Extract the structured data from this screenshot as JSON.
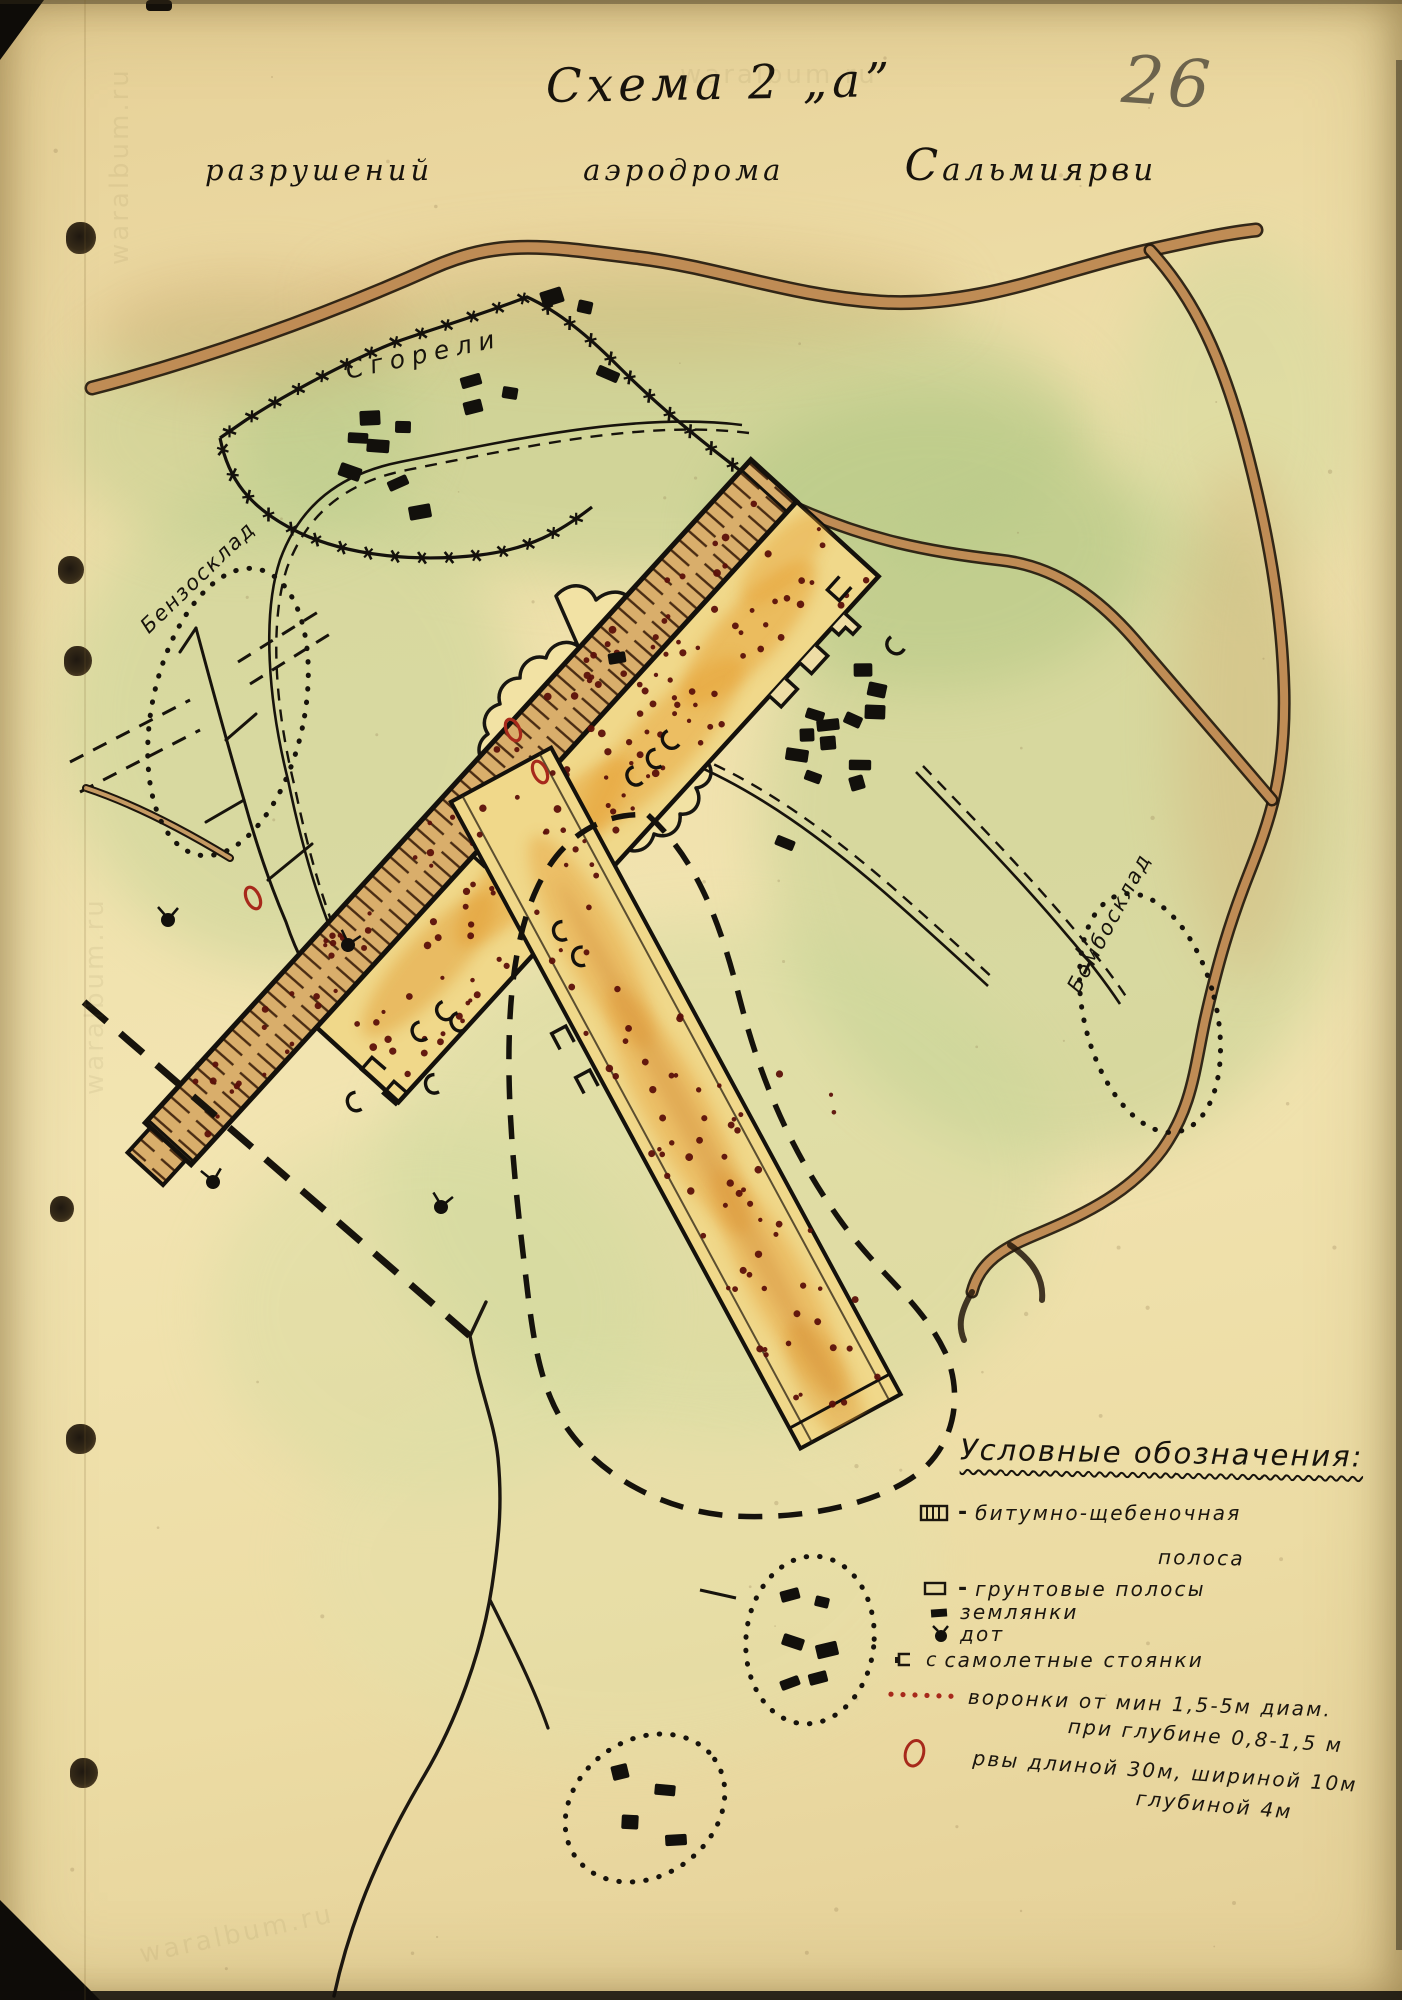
{
  "document": {
    "title": "Схема 2 „а”",
    "subtitle_words": [
      "разрушений",
      "аэродрома",
      "Сальмиярви"
    ],
    "page_number": "26",
    "watermark": "waralbum.ru"
  },
  "map": {
    "labels": {
      "burned_area": "Сгорели",
      "fuel_depot": "Бензосклад",
      "bomb_depot": "Бомбосклад"
    },
    "features": {
      "dugouts": [
        [
          471,
          381
        ],
        [
          510,
          393
        ],
        [
          473,
          407
        ],
        [
          370,
          418
        ],
        [
          403,
          427
        ],
        [
          358,
          438
        ],
        [
          378,
          446
        ],
        [
          350,
          472
        ],
        [
          398,
          483
        ],
        [
          420,
          512
        ],
        [
          608,
          374
        ],
        [
          552,
          297
        ],
        [
          585,
          307
        ],
        [
          863,
          670
        ],
        [
          877,
          690
        ],
        [
          875,
          712
        ],
        [
          853,
          720
        ],
        [
          815,
          715
        ],
        [
          828,
          725
        ],
        [
          807,
          735
        ],
        [
          828,
          743
        ],
        [
          797,
          755
        ],
        [
          860,
          765
        ],
        [
          813,
          777
        ],
        [
          857,
          783
        ],
        [
          785,
          843
        ],
        [
          617,
          658
        ],
        [
          790,
          1595
        ],
        [
          822,
          1602
        ],
        [
          793,
          1642
        ],
        [
          827,
          1650
        ],
        [
          790,
          1683
        ],
        [
          818,
          1678
        ],
        [
          620,
          1772
        ],
        [
          665,
          1790
        ],
        [
          630,
          1822
        ],
        [
          676,
          1840
        ]
      ],
      "pillboxes": [
        [
          168,
          920,
          0
        ],
        [
          348,
          945,
          15
        ],
        [
          213,
          1182,
          -10
        ],
        [
          441,
          1207,
          10
        ]
      ],
      "aircraft_stand_marks": [
        [
          632,
          778,
          -30
        ],
        [
          652,
          760,
          -20
        ],
        [
          668,
          742,
          -40
        ],
        [
          558,
          932,
          -15
        ],
        [
          577,
          957,
          -8
        ],
        [
          417,
          1033,
          -25
        ],
        [
          442,
          1013,
          -35
        ],
        [
          456,
          1024,
          -30
        ],
        [
          430,
          1085,
          -15
        ],
        [
          352,
          1103,
          -20
        ],
        [
          893,
          648,
          -48
        ]
      ],
      "parking_bays": [
        [
          372,
          1068,
          41
        ],
        [
          394,
          1092,
          41
        ],
        [
          838,
          590,
          -48
        ],
        [
          562,
          1036,
          62
        ],
        [
          586,
          1080,
          62
        ]
      ],
      "ditch_marks": [
        [
          513,
          730
        ],
        [
          540,
          772
        ],
        [
          253,
          898
        ]
      ],
      "crater_fields": [
        {
          "target": "strip-craters",
          "x": 15,
          "y": -26,
          "w": 860,
          "h": 52,
          "count": 58
        },
        {
          "target": "wide-craters",
          "x": -5,
          "y": -136,
          "w": 700,
          "h": 98,
          "count": 95
        },
        {
          "target": "rw2-craters",
          "x": -20,
          "y": -50,
          "w": 700,
          "h": 100,
          "count": 72
        },
        {
          "target": "abs-craters",
          "x": 560,
          "y": 620,
          "w": 170,
          "h": 200,
          "count": 13
        },
        {
          "target": "abs-craters",
          "x": 680,
          "y": 1040,
          "w": 190,
          "h": 260,
          "count": 12
        }
      ],
      "crater_color": "#5c100a"
    }
  },
  "legend": {
    "title": "Условные обозначения:",
    "items": [
      {
        "label": "битумно-щебеночная",
        "label2": "полоса",
        "dash": "-"
      },
      {
        "label": "грунтовые полосы",
        "dash": "-"
      },
      {
        "label": "землянки",
        "dash": ""
      },
      {
        "label": "дот",
        "dash": ""
      },
      {
        "label": "самолетные стоянки",
        "icon_letter": "с",
        "dash": ""
      },
      {
        "label": "воронки от мин  1,5-5м диам.",
        "label2": "при глубине 0,8-1,5 м",
        "dash": ""
      },
      {
        "label": "рвы  длиной 30м, шириной 10м",
        "label2": "глубиной 4м",
        "dash": ""
      }
    ]
  },
  "colors": {
    "paper": "#eedda6",
    "green_wash": "#b9cc8e",
    "road_brown": "#bf8c55",
    "runway_yellow": "#f0d88a",
    "hatch_tan": "#d9ae6b",
    "ink": "#17130c",
    "crater_red": "#5c100a",
    "mark_red": "#a7291b",
    "pencil": "#57503f"
  }
}
